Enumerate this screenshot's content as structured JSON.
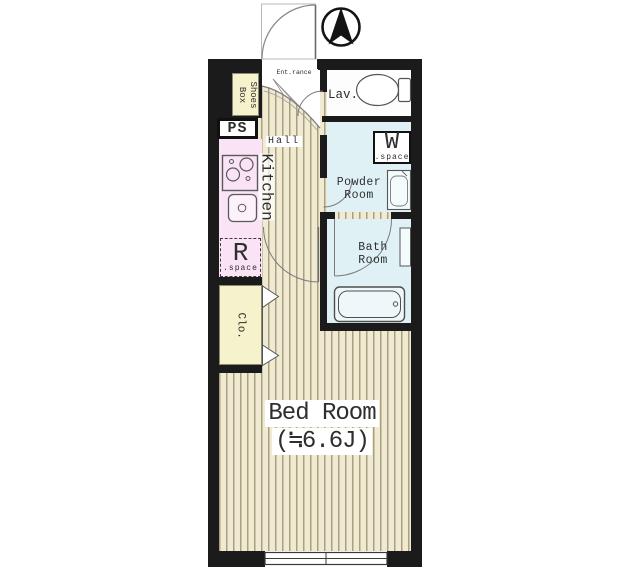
{
  "plan": {
    "compass": {
      "name": "north-arrow"
    },
    "rooms": {
      "entrance": {
        "label": "Ent.rance"
      },
      "shoes_box": {
        "line1": "Shoes",
        "line2": "Box"
      },
      "ps": {
        "label": "PS"
      },
      "hall": {
        "label": "Hall"
      },
      "kitchen": {
        "label": "Kitchen"
      },
      "lavatory": {
        "label": "Lav."
      },
      "washer_space": {
        "main": "W",
        "sub": ".space"
      },
      "powder_room": {
        "line1": "Powder",
        "line2": "Room"
      },
      "bath_room": {
        "line1": "Bath",
        "line2": "Room"
      },
      "refrigerator_space": {
        "main": "R",
        "sub": ".space"
      },
      "closet": {
        "label": "Clo."
      },
      "bed_room": {
        "label": "Bed Room",
        "size": "(≒6.6J)"
      }
    },
    "colors": {
      "wall": "#1b1b1b",
      "floor": "#f0ead2",
      "floor_stripe": "#a8a07e",
      "kitchen_pink": "#f9e3f4",
      "closet_cream": "#f6f2cb",
      "wet_room_cyan": "#e0f1f6",
      "lavatory_white": "#fdfdfd",
      "fixture_line": "#555555",
      "text": "#2e2e2e"
    }
  }
}
